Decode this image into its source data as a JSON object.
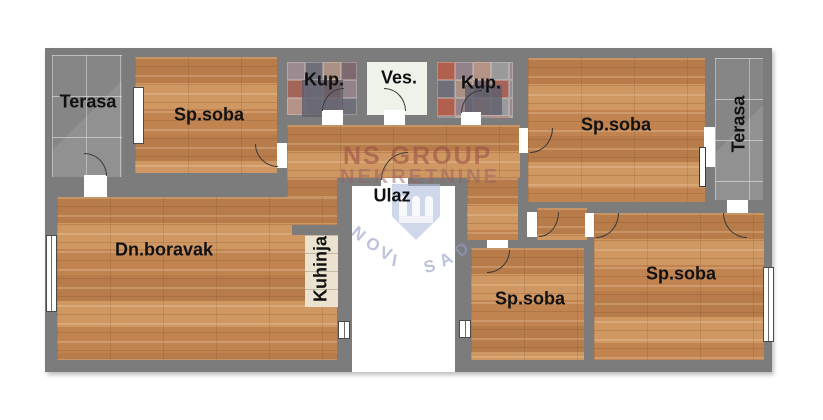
{
  "plan": {
    "rooms": {
      "terasa_left": {
        "label": "Terasa"
      },
      "spsoba1": {
        "label": "Sp.soba"
      },
      "kup1": {
        "label": "Kup."
      },
      "ves": {
        "label": "Ves."
      },
      "kup2": {
        "label": "Kup."
      },
      "spsoba2": {
        "label": "Sp.soba"
      },
      "terasa_right": {
        "label": "Terasa"
      },
      "dnboravak": {
        "label": "Dn.boravak"
      },
      "kuhinja": {
        "label": "Kuhinja"
      },
      "ulaz": {
        "label": "Ulaz"
      },
      "spsoba3": {
        "label": "Sp.soba"
      },
      "spsoba4": {
        "label": "Sp.soba"
      }
    }
  },
  "watermark": {
    "line1": "NS GROUP",
    "line2": "NEKRETNINE",
    "city": "NOVI SAD"
  },
  "colors": {
    "wall": "#7c7c7c",
    "wood": "#c68d5b",
    "terrace_tile": "#8d8d8d",
    "ves_floor": "#eef2e9",
    "ulaz_floor": "#ffffff",
    "kitchen_counter": "#ebe2cf",
    "bath_dark": "rgba(95,95,108,0.82)",
    "label_text": "#111111",
    "watermark_red": "rgba(151,73,66,0.55)",
    "watermark_red2": "rgba(150,95,100,0.5)",
    "watermark_blue": "rgba(147,155,200,0.62)",
    "watermark_shield": "rgba(175,188,222,0.6)",
    "bath_tiles": [
      "#9b8a90",
      "#7d6a71",
      "#b2604e",
      "#9a999c",
      "#ab9184",
      "#8f8f97",
      "#b59387",
      "#6f6f79",
      "#a3655a",
      "#93828a"
    ]
  }
}
